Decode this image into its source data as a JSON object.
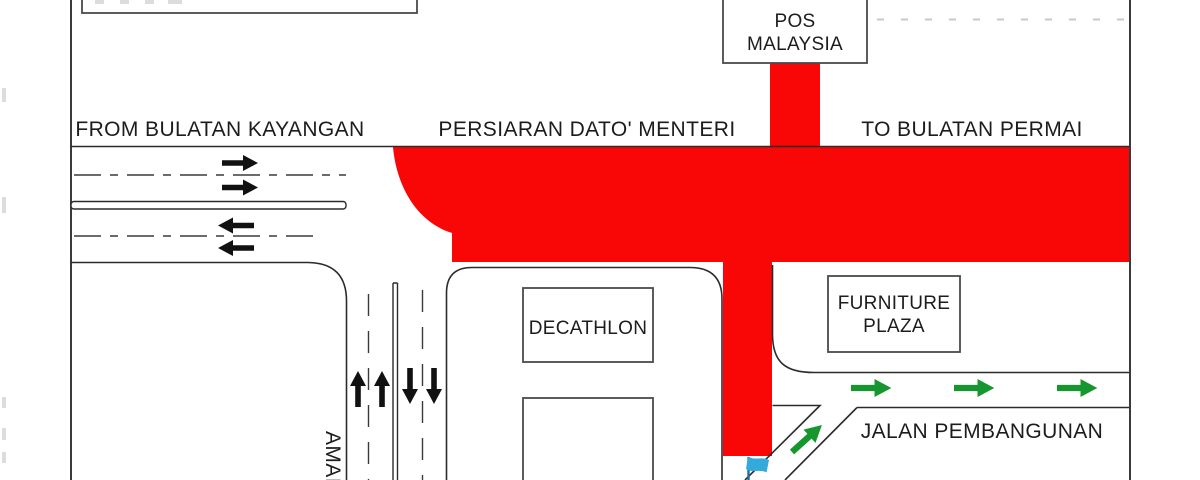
{
  "labels": {
    "from_road": "FROM BULATAN KAYANGAN",
    "main_road": "PERSIARAN DATO' MENTERI",
    "to_road": "TO BULATAN PERMAI",
    "side_road": "JALAN PEMBANGUNAN",
    "south_road_partial": "AMAI"
  },
  "buildings": {
    "pos_malaysia": {
      "line1": "POS",
      "line2": "MALAYSIA"
    },
    "decathlon": {
      "label": "DECATHLON"
    },
    "furniture_plaza": {
      "line1": "FURNITURE",
      "line2": "PLAZA"
    }
  },
  "colors": {
    "closed_road": "#f90606",
    "detour_arrow": "#16962e",
    "lane_arrow": "#111111",
    "flag": "#33a9dc",
    "flag_pole": "#1b6ea6",
    "outline": "#2b2b2b"
  },
  "icons": {
    "flag": "route-endpoint-flag-icon",
    "black_arrow": "lane-direction-arrow-icon",
    "green_arrow": "detour-direction-arrow-icon"
  }
}
